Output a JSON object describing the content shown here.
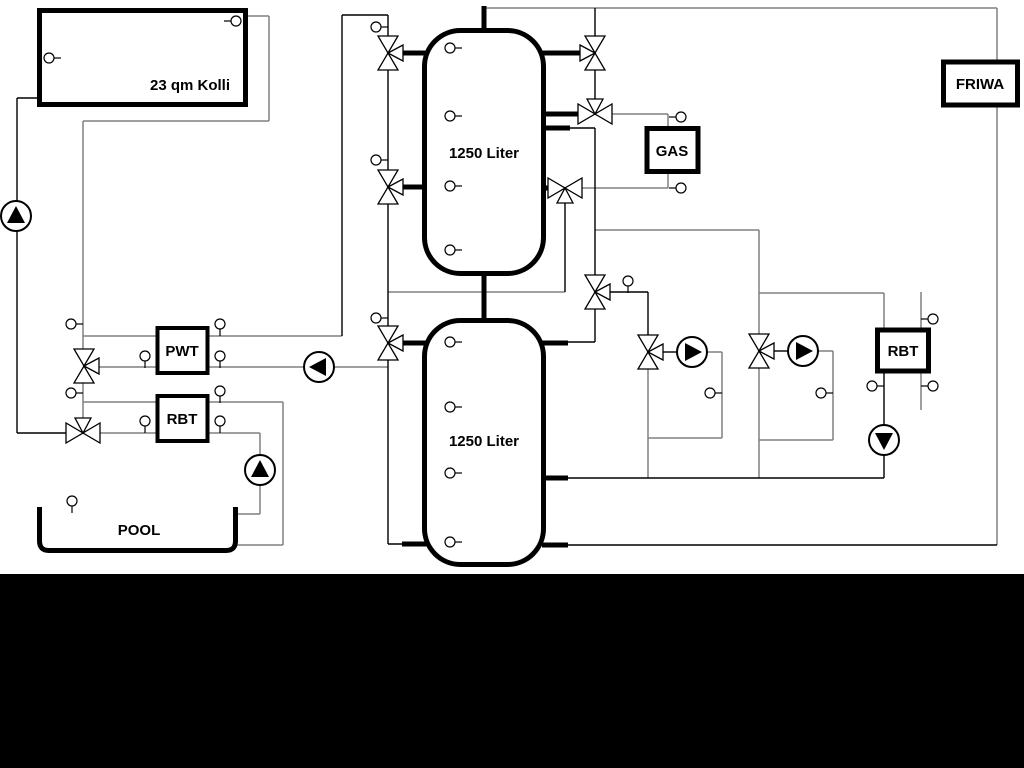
{
  "labels": {
    "collector": "23 qm Kolli",
    "tank_upper": "1250 Liter",
    "tank_lower": "1250 Liter",
    "gas": "GAS",
    "friwa": "FRIWA",
    "pwt": "PWT",
    "rbt_left": "RBT",
    "rbt_right": "RBT",
    "pool": "POOL"
  },
  "colors": {
    "background": "#ffffff",
    "ink": "#000000",
    "pipe_gray": "#808080",
    "bottom_band": "#000000"
  },
  "equipment_counts": {
    "pumps": 6,
    "three_way_valves": 11,
    "temperature_sensors": 30
  }
}
